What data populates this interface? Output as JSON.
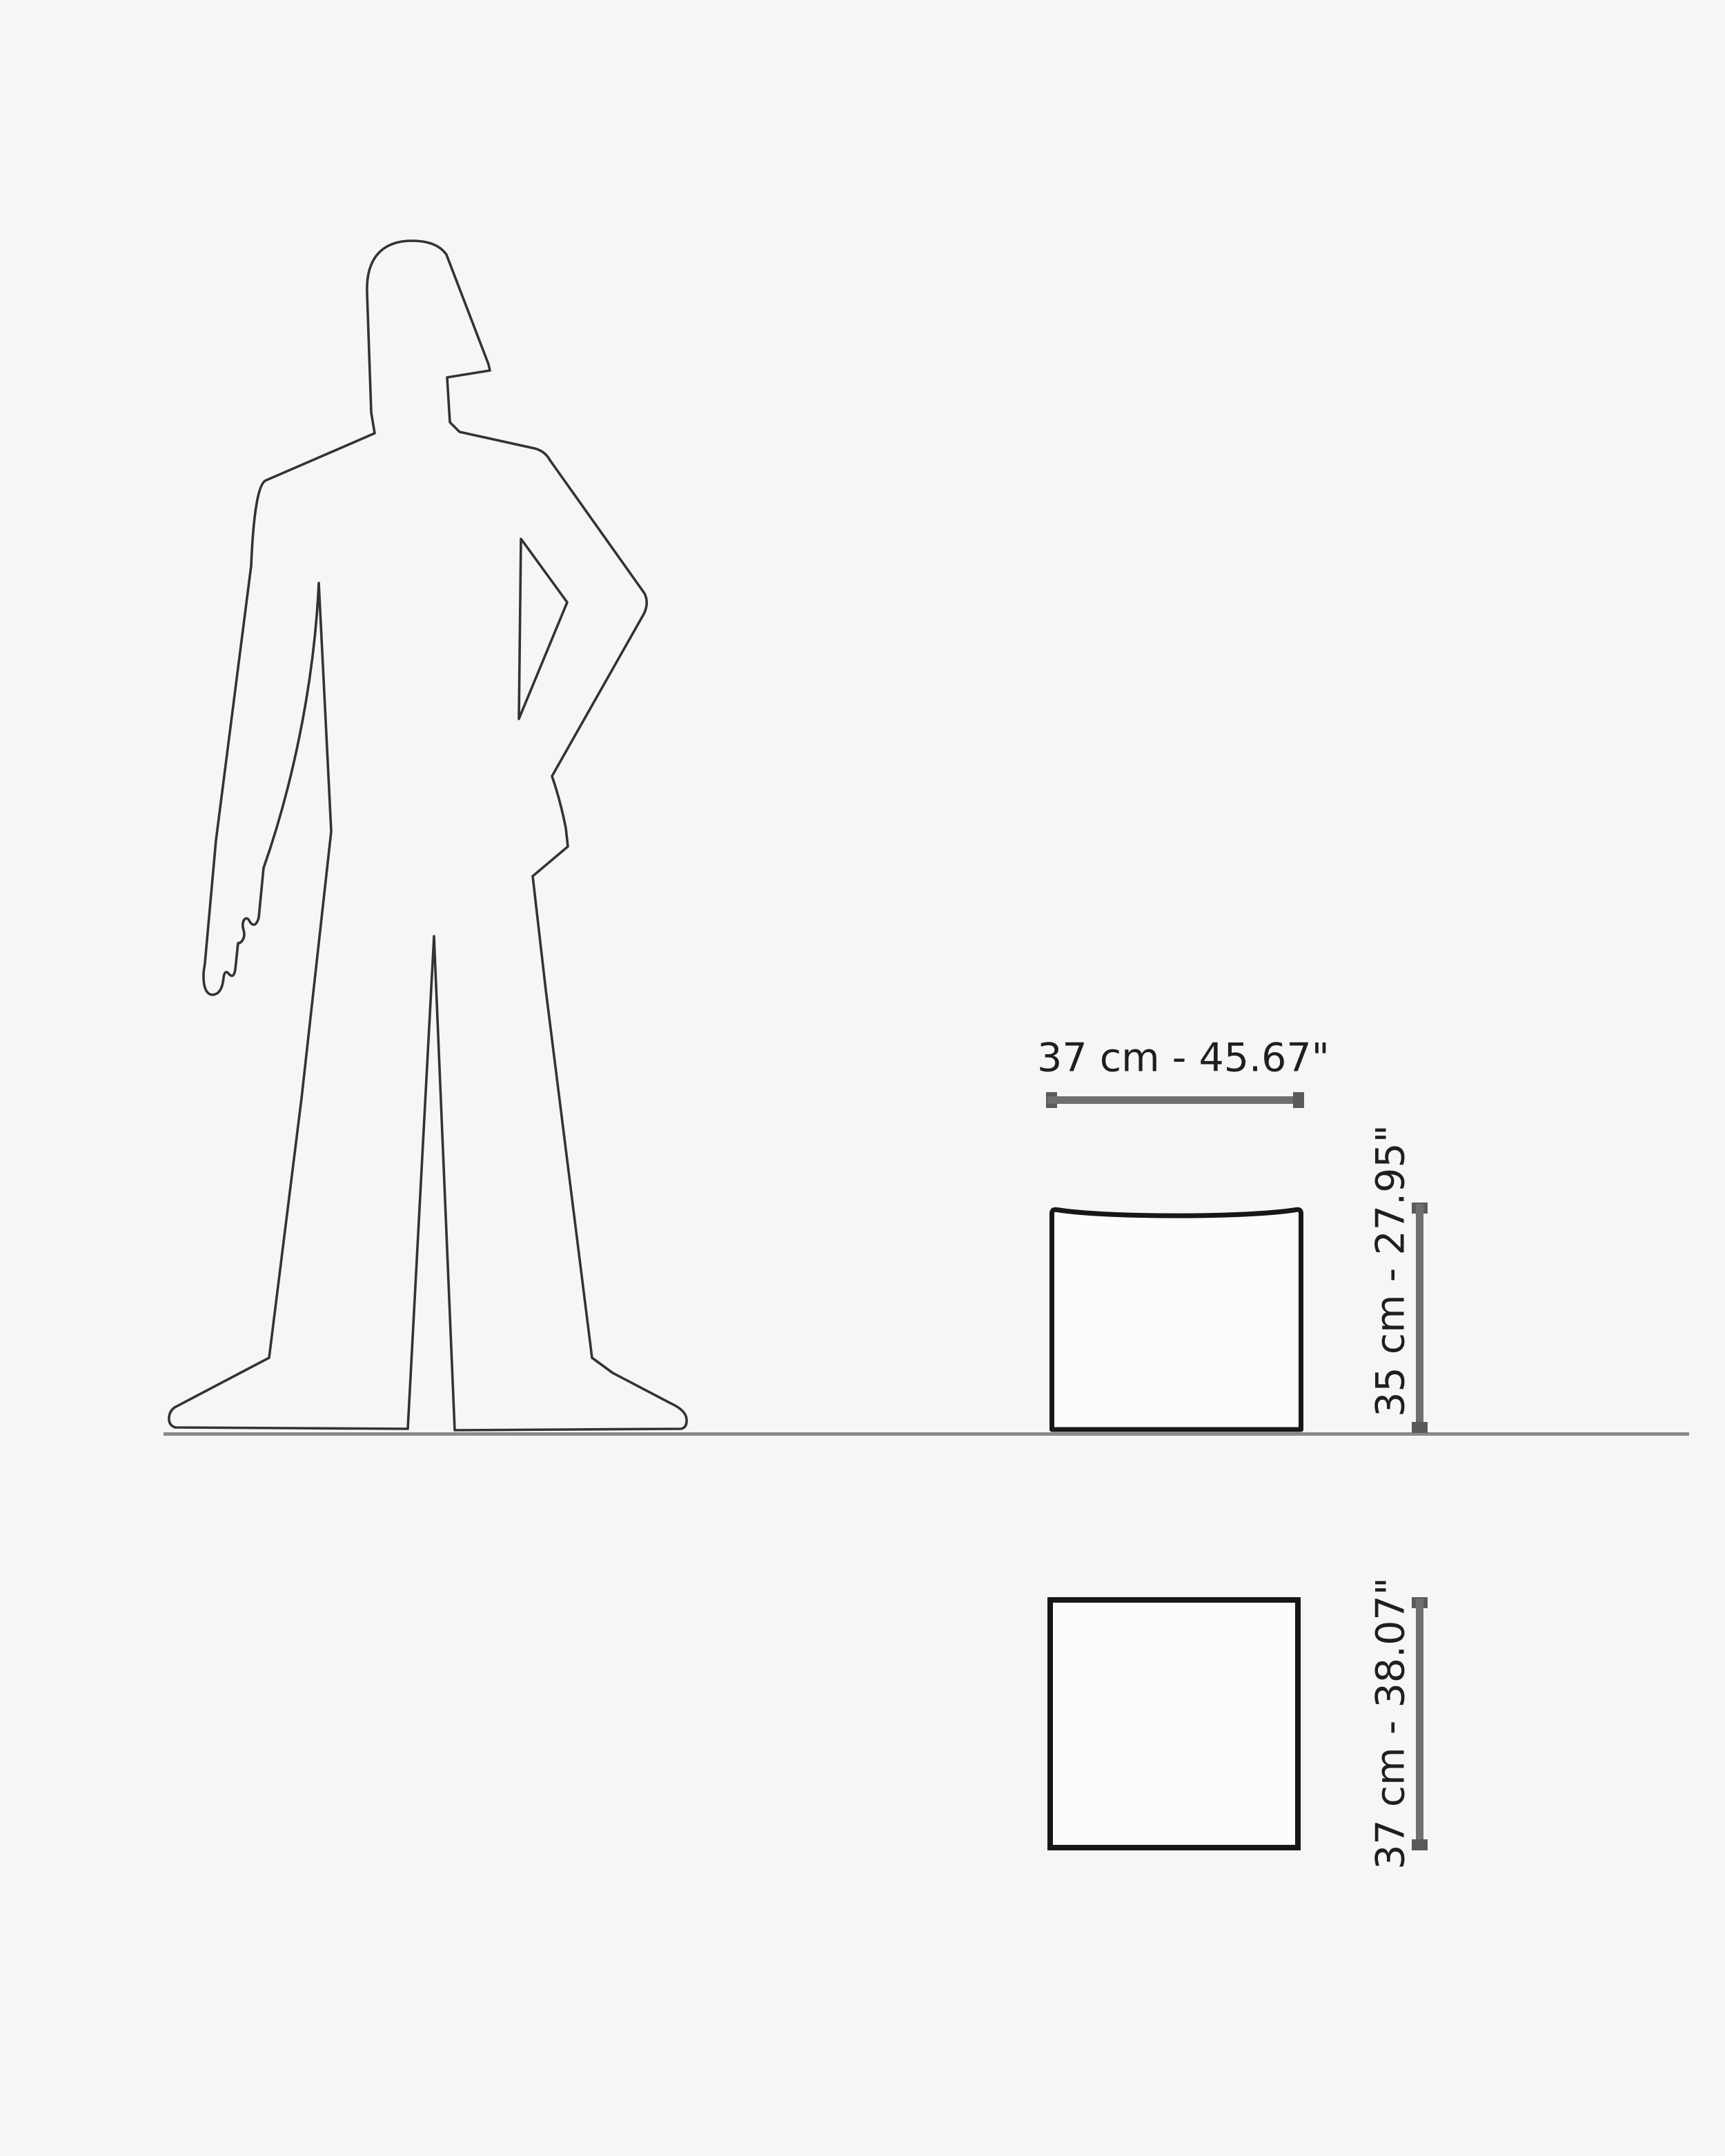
{
  "diagram": {
    "figure_icon": "standing-human-silhouette-icon",
    "ground_icon": "ground-line",
    "front_view_icon": "stool-front-outline",
    "top_view_icon": "stool-top-outline"
  },
  "dimensions": {
    "width": {
      "label": "37 cm - 45.67\"",
      "cm": "37",
      "inches": "45.67"
    },
    "height": {
      "label": "35 cm - 27.95\"",
      "cm": "35",
      "inches": "27.95"
    },
    "depth": {
      "label": "37 cm - 38.07\"",
      "cm": "37",
      "inches": "38.07"
    }
  },
  "colors": {
    "background": "#f6f6f6",
    "silhouette_stroke": "#333333",
    "shape_stroke": "#171717",
    "shape_fill": "#fcfcfc",
    "ground_line": "#8a8a8a",
    "dimension_line": "#6f6f6f",
    "dimension_cap": "#5a5a5a",
    "label_text": "#1f1f1f"
  }
}
